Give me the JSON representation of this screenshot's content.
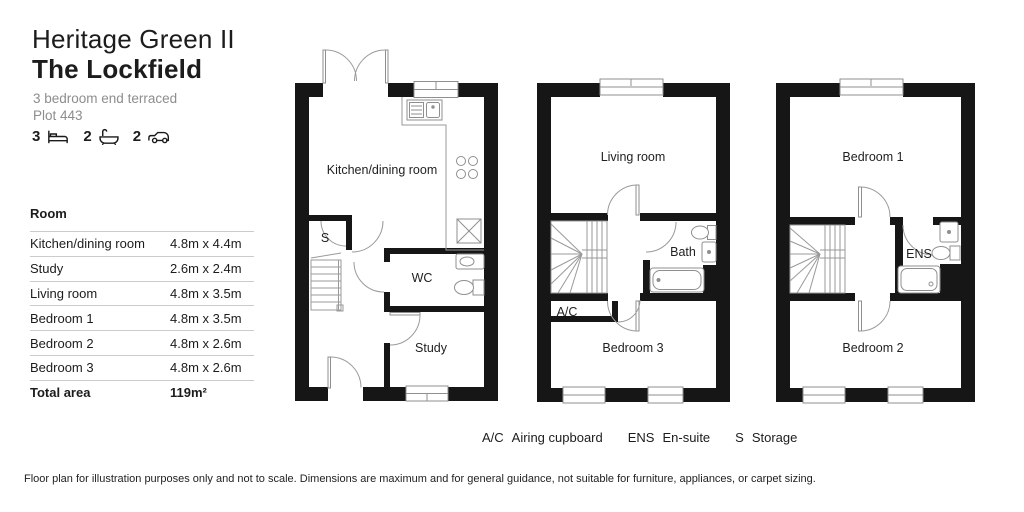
{
  "header": {
    "development": "Heritage Green II",
    "house_name": "The Lockfield",
    "type": "3 bedroom end terraced",
    "plot": "Plot 443"
  },
  "stats": {
    "beds": "3",
    "baths": "2",
    "cars": "2"
  },
  "room_table": {
    "header": "Room",
    "rows": [
      {
        "room": "Kitchen/dining room",
        "dims": "4.8m x 4.4m"
      },
      {
        "room": "Study",
        "dims": "2.6m x 2.4m"
      },
      {
        "room": "Living room",
        "dims": "4.8m x 3.5m"
      },
      {
        "room": "Bedroom 1",
        "dims": "4.8m x 3.5m"
      },
      {
        "room": "Bedroom 2",
        "dims": "4.8m x 2.6m"
      },
      {
        "room": "Bedroom 3",
        "dims": "4.8m x 2.6m"
      }
    ],
    "total_label": "Total area",
    "total_value": "119m²"
  },
  "plans": {
    "ground": {
      "kitchen": "Kitchen/dining room",
      "storage": "S",
      "wc": "WC",
      "study": "Study"
    },
    "first": {
      "living": "Living room",
      "bath": "Bath",
      "airing": "A/C",
      "bedroom3": "Bedroom 3"
    },
    "second": {
      "bedroom1": "Bedroom 1",
      "ensuite": "ENS",
      "bedroom2": "Bedroom 2"
    }
  },
  "legend": [
    {
      "abbr": "A/C",
      "label": "Airing cupboard"
    },
    {
      "abbr": "ENS",
      "label": "En-suite"
    },
    {
      "abbr": "S",
      "label": "Storage"
    }
  ],
  "disclaimer": "Floor plan for illustration purposes only and not to scale. Dimensions are maximum and for general guidance, not suitable for furniture, appliances, or carpet sizing.",
  "colors": {
    "wall": "#161616",
    "line": "#8f8f8f",
    "text": "#1c1c1c",
    "muted": "#8d8d8d"
  }
}
